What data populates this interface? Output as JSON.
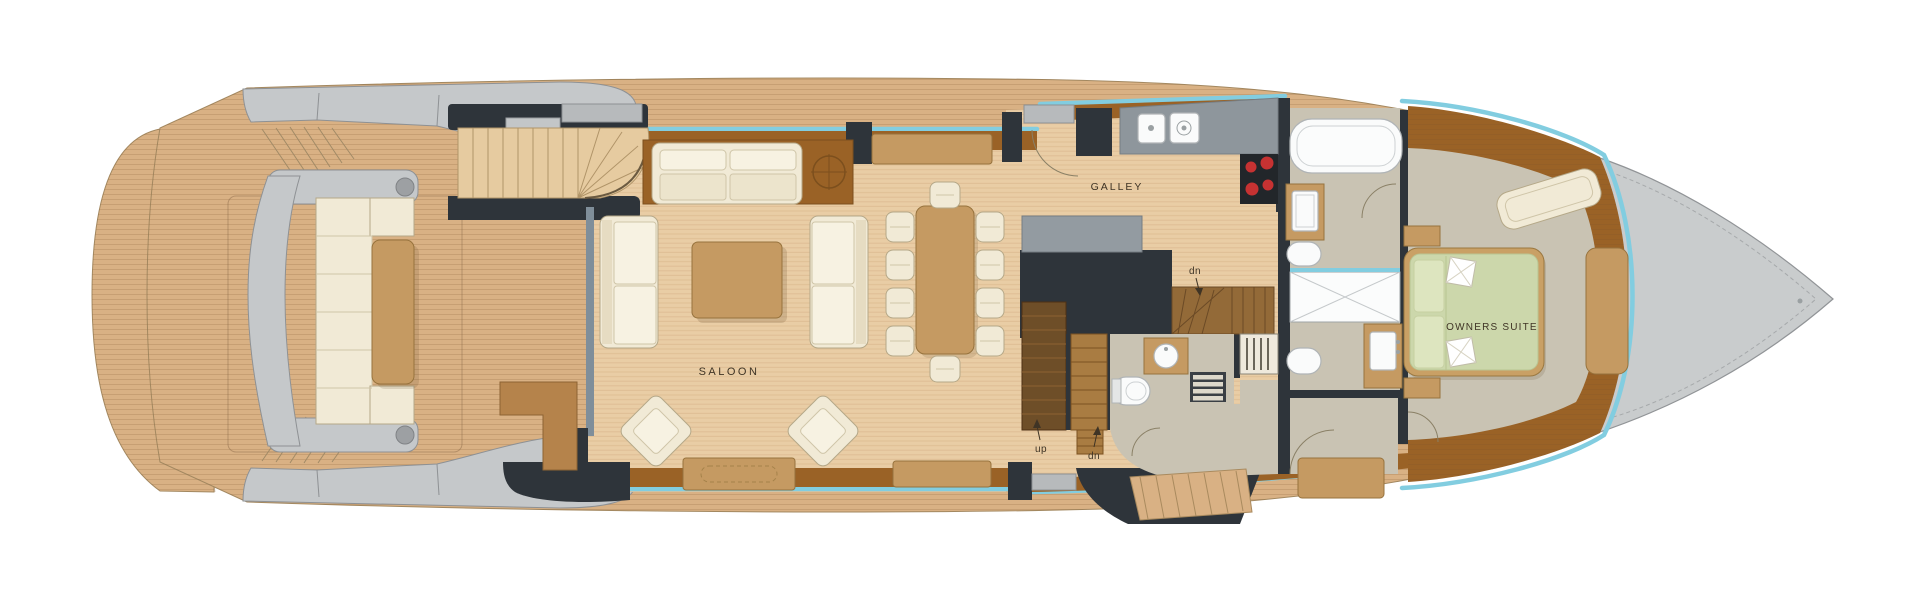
{
  "deck_plan": {
    "rooms": {
      "saloon_label": "SALOON",
      "galley_label": "GALLEY",
      "owners_suite_label": "OWNERS SUITE"
    },
    "stairs": {
      "up_label": "up",
      "down_label": "dn",
      "galley_down_label": "dn"
    },
    "colors": {
      "teak_deck": "#d9b184",
      "interior_floor": "#e9cda5",
      "wall_charcoal": "#2e343a",
      "wood_trim_brown": "#9a6226",
      "window_glass_blue": "#82cde0",
      "superstructure_gray": "#c5c8ca",
      "bow_deck_gray": "#c9cccd",
      "carpet_taupe": "#c9c3b3",
      "cream_upholstery": "#f1ead6",
      "wood_furniture_tan": "#c59a62",
      "bed_green": "#ccd7ab",
      "stair_dark_brown": "#6e4e28",
      "stair_light_brown": "#a97c42",
      "counter_gray": "#8e969c",
      "burner_red": "#c63232",
      "fixture_white": "#fafbfb"
    }
  }
}
